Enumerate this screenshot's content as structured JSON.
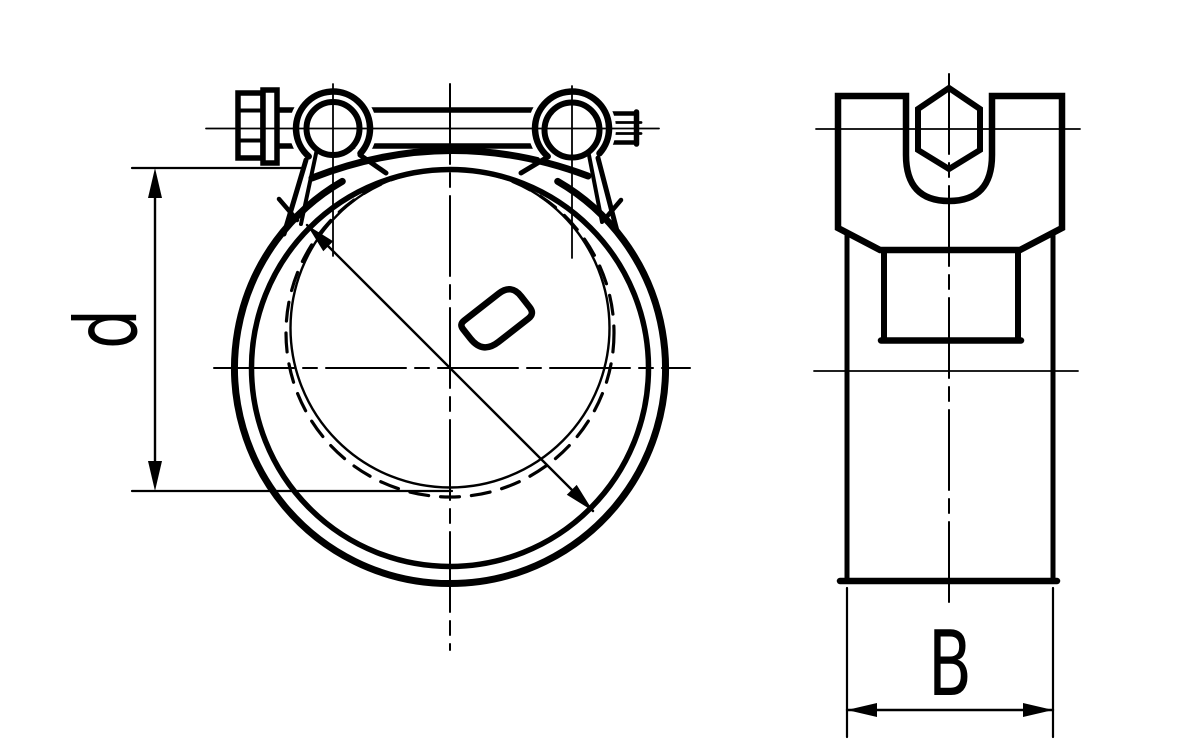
{
  "page": {
    "width": 1200,
    "height": 750,
    "background": "#ffffff",
    "line_color": "#000000"
  },
  "drawing": {
    "subject": "Heavy-duty T-bolt hose clamp - technical drawing with front and side orthographic views",
    "front_view": {
      "name": "front view (clamp band with bolt and trunnions)",
      "dimension_label": "d"
    },
    "side_view": {
      "name": "side view (band width with hex bolt head in saddle)",
      "dimension_label": "B"
    }
  }
}
